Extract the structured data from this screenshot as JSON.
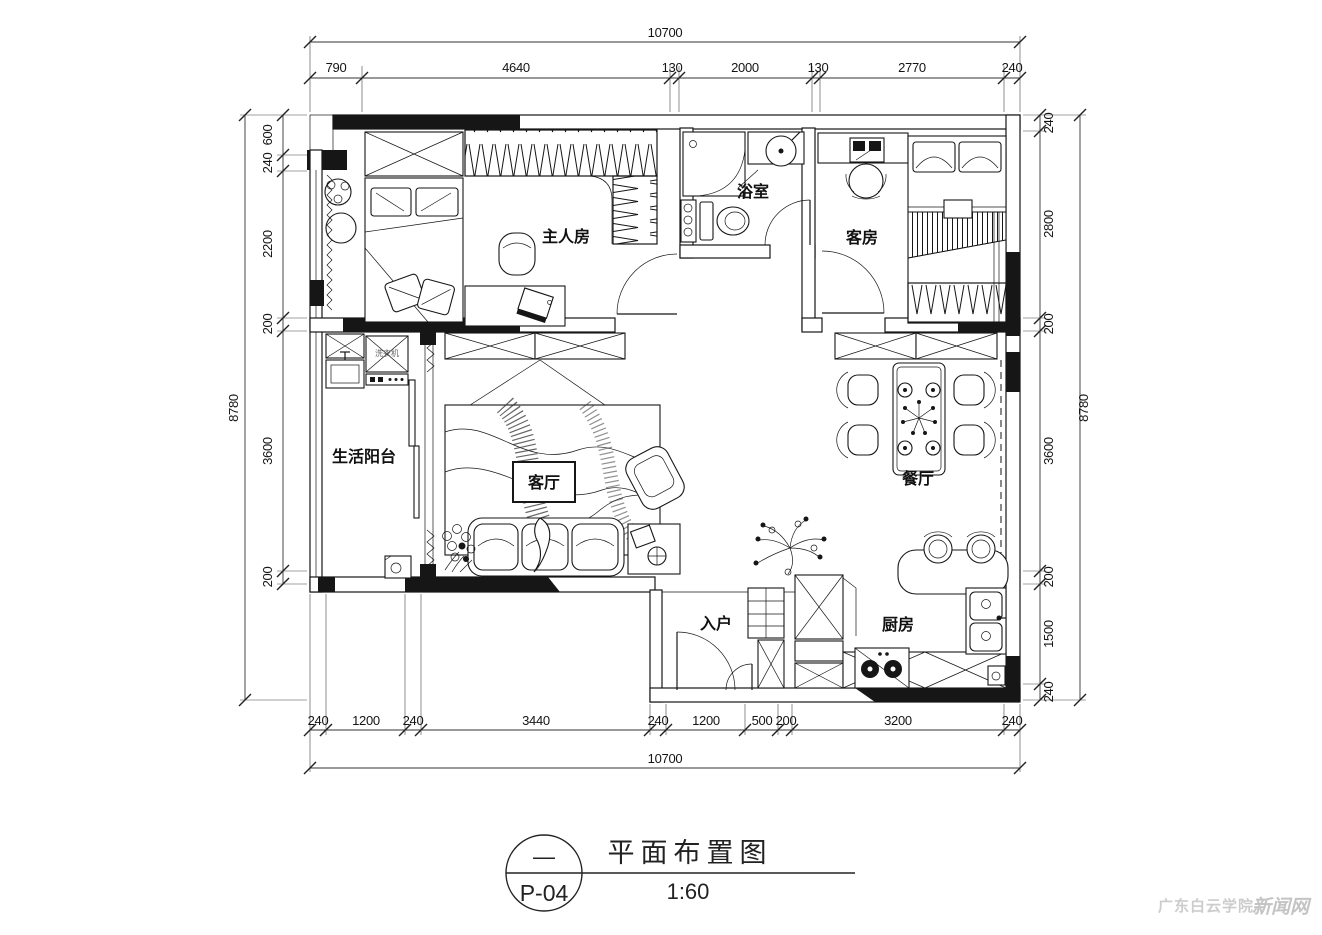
{
  "title_block": {
    "name": "平面布置图",
    "scale": "1:60",
    "sheet": "P-04",
    "rev": "—"
  },
  "watermark": {
    "part1": "广东白云学院",
    "part2": "新闻网"
  },
  "rooms": {
    "master": "主人房",
    "bath": "浴室",
    "guest": "客房",
    "balcony": "生活阳台",
    "living": "客厅",
    "dining": "餐厅",
    "entry": "入户",
    "kitchen": "厨房",
    "washer": "洗衣机"
  },
  "dims": {
    "top": {
      "total": "10700",
      "segs": [
        "790",
        "4640",
        "130",
        "2000",
        "130",
        "2770",
        "240"
      ]
    },
    "bottom": {
      "total": "10700",
      "segs": [
        "240",
        "1200",
        "240",
        "3440",
        "240",
        "1200",
        "500",
        "200",
        "3200",
        "240"
      ]
    },
    "left": {
      "total": "8780",
      "segs": [
        "600",
        "240",
        "2200",
        "200",
        "3600",
        "200"
      ]
    },
    "right": {
      "total": "8780",
      "segs": [
        "240",
        "2800",
        "200",
        "3600",
        "200",
        "1500",
        "240"
      ]
    }
  }
}
